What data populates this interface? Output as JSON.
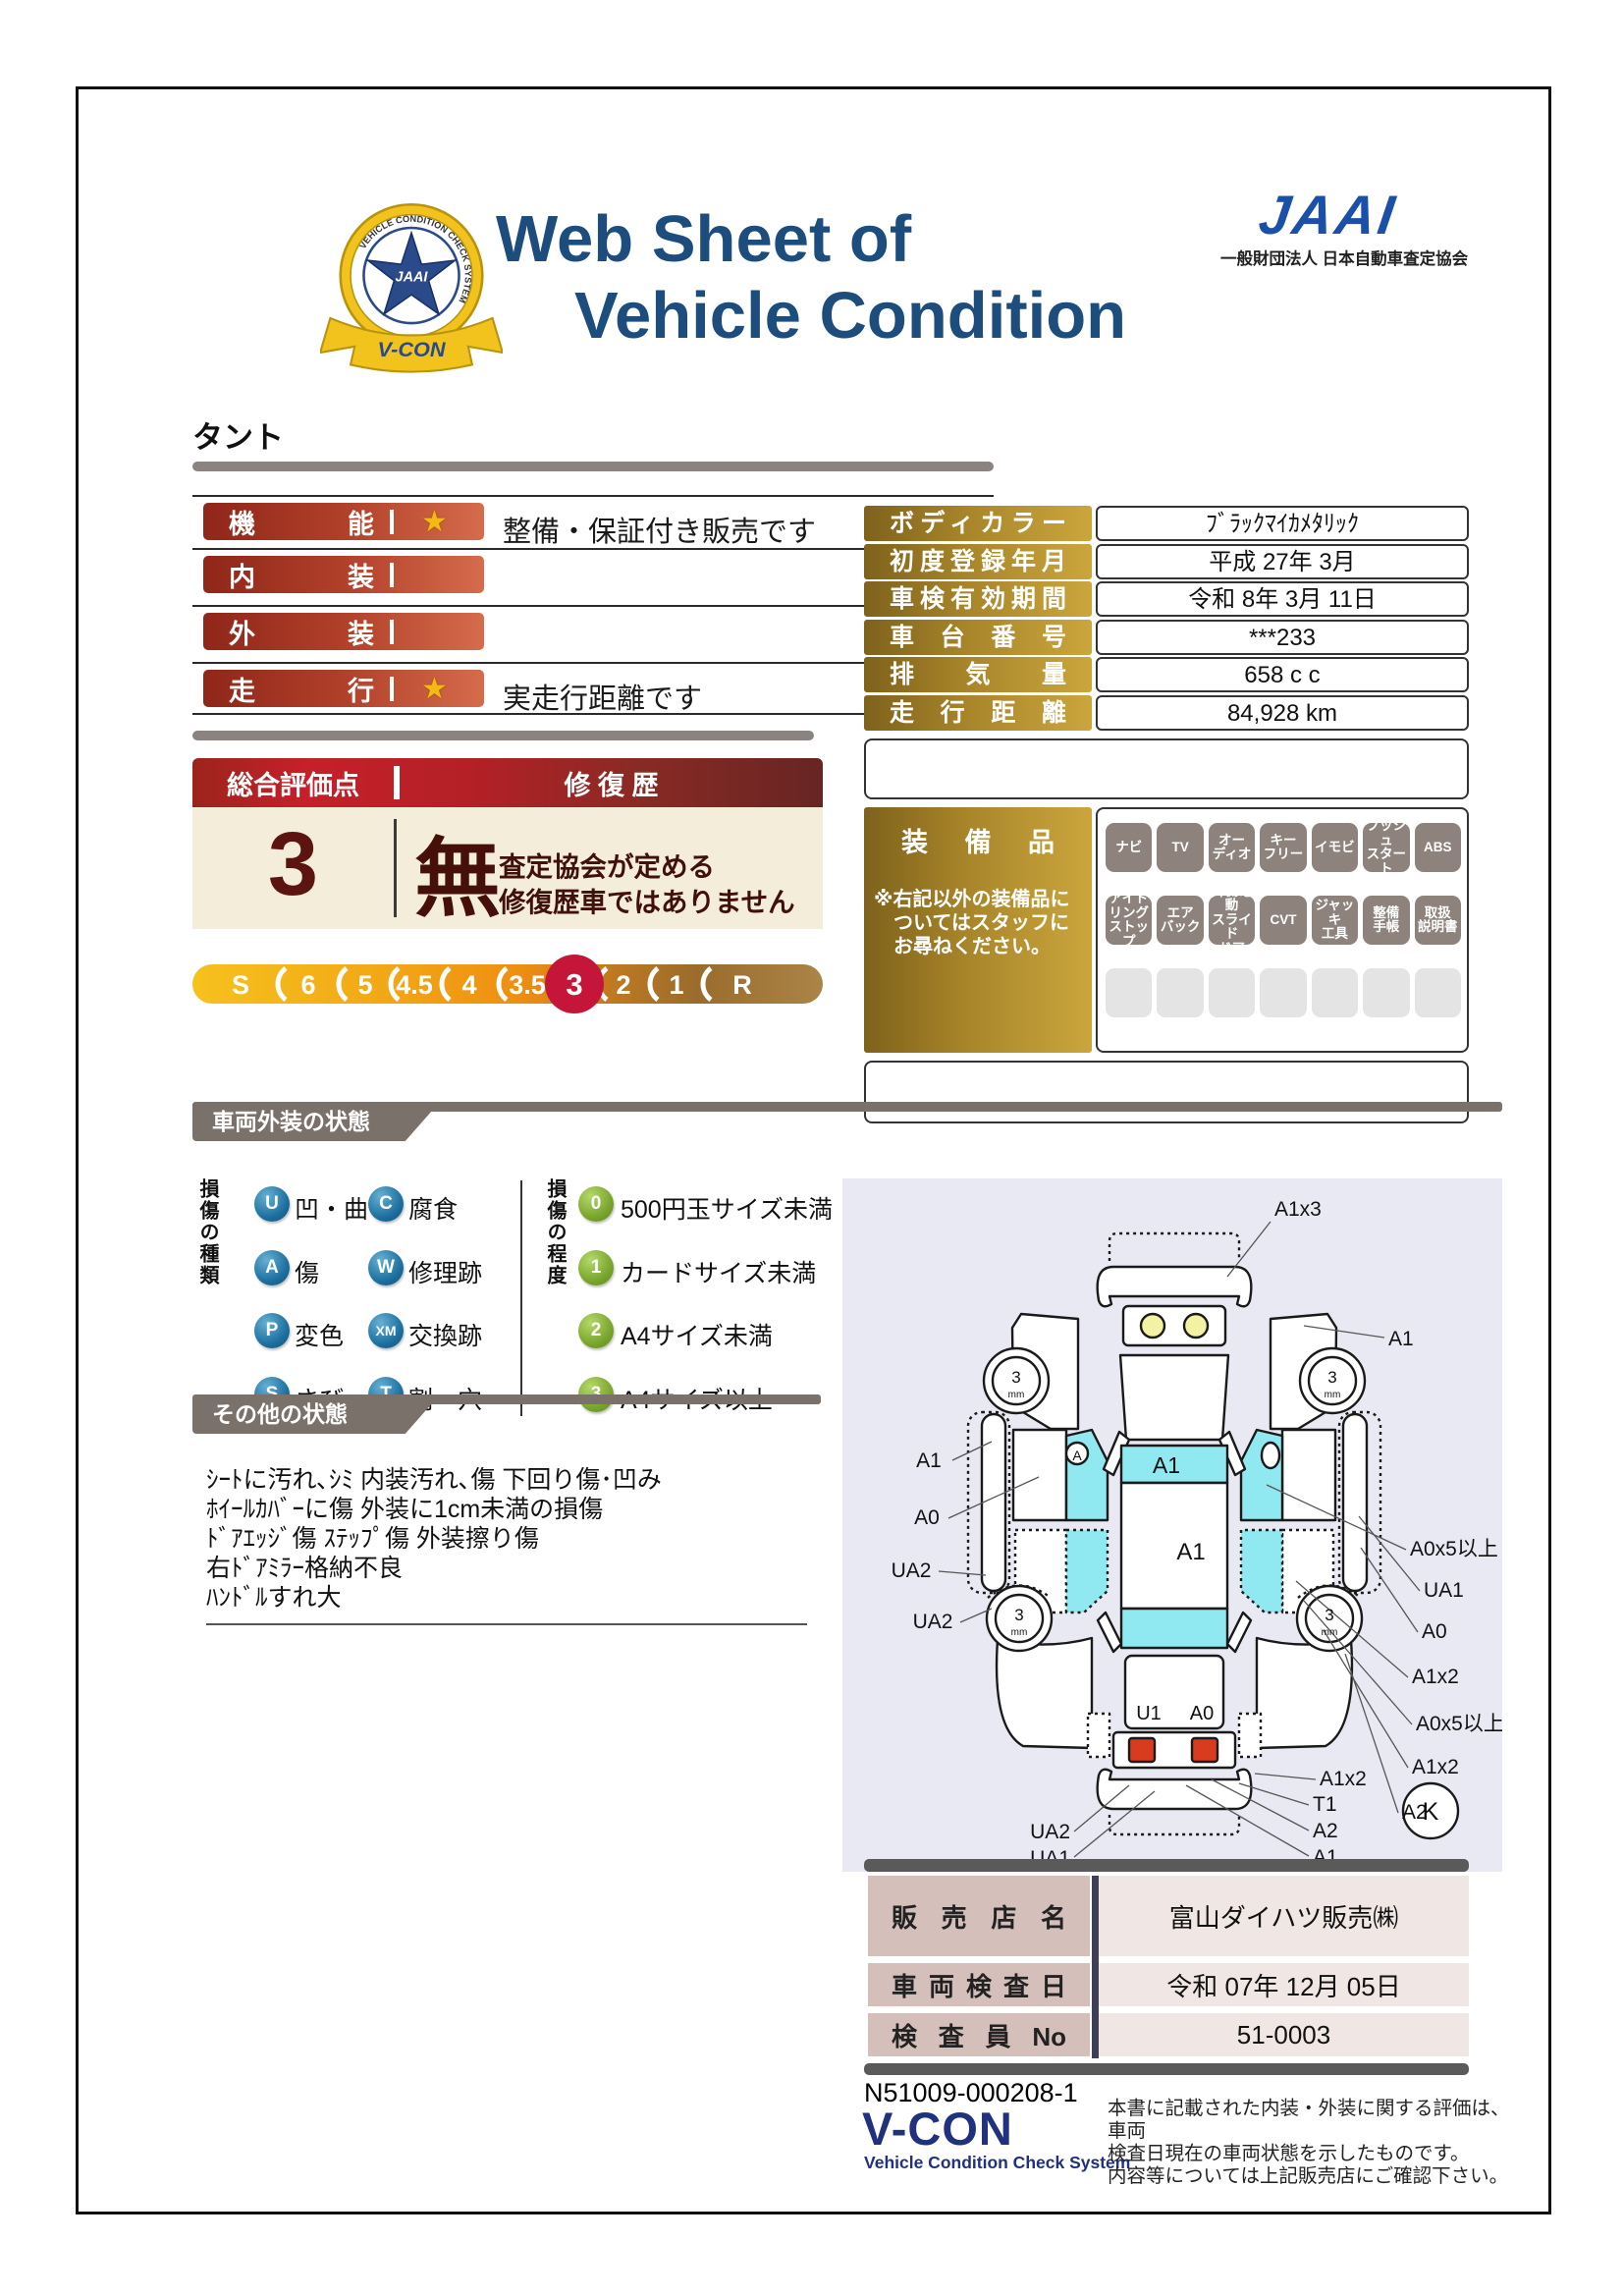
{
  "header": {
    "title_line1": "Web Sheet of",
    "title_line2": "Vehicle Condition",
    "jaai_mark": "JAAI",
    "jaai_org": "一般財団法人 日本自動車査定協会",
    "badge": {
      "ring": "VEHICLE CONDITION CHECK SYSTEM",
      "star_text": "JAAI",
      "ribbon": "V-CON"
    }
  },
  "vehicle": {
    "name": "タント"
  },
  "ratings": {
    "rows": [
      {
        "label": "機能",
        "star": true,
        "note": "整備・保証付き販売です"
      },
      {
        "label": "内装",
        "star": false,
        "note": ""
      },
      {
        "label": "外装",
        "star": false,
        "note": ""
      },
      {
        "label": "走行",
        "star": true,
        "note": "実走行距離です"
      }
    ]
  },
  "score": {
    "header_left": "総合評価点",
    "header_right": "修 復 歴",
    "value": "3",
    "repair": "無",
    "repair_note1": "査定協会が定める",
    "repair_note2": "修復歴車ではありません",
    "scale": [
      "S",
      "6",
      "5",
      "4.5",
      "4",
      "3.5",
      "3",
      "2",
      "1",
      "R"
    ],
    "selected": "3"
  },
  "info": {
    "rows": [
      {
        "label": "ボディカラー",
        "value": "ﾌﾞﾗｯｸﾏｲｶﾒﾀﾘｯｸ"
      },
      {
        "label": "初度登録年月",
        "value": "平成 27年 3月"
      },
      {
        "label": "車検有効期間",
        "value": "令和 8年 3月 11日"
      },
      {
        "label": "車台番号",
        "value": "***233"
      },
      {
        "label": "排気量",
        "value": "658 c c"
      },
      {
        "label": "走行距離",
        "value": "84,928 km"
      }
    ]
  },
  "equipment": {
    "title": "装備品",
    "note": "※右記以外の装備品に\n　ついてはスタッフに\n　お尋ねください。",
    "items": [
      "ナビ",
      "TV",
      "オー\nディオ",
      "キー\nフリー",
      "イモビ",
      "プッシュ\nスタート",
      "ABS",
      "アイド\nリング\nストップ",
      "エア\nバック",
      "片側電動\nスライド\nドア",
      "CVT",
      "ジャッキ\n工具",
      "整備\n手帳",
      "取扱\n説明書"
    ]
  },
  "exterior": {
    "title": "車両外装の状態",
    "kind_axis": "損傷の種類",
    "kinds": [
      {
        "code": "U",
        "label": "凹・曲"
      },
      {
        "code": "C",
        "label": "腐食"
      },
      {
        "code": "A",
        "label": "傷"
      },
      {
        "code": "W",
        "label": "修理跡"
      },
      {
        "code": "P",
        "label": "変色"
      },
      {
        "code": "XM",
        "label": "交換跡"
      },
      {
        "code": "S",
        "label": "さび"
      },
      {
        "code": "T",
        "label": "割・穴"
      }
    ],
    "degree_axis": "損傷の程度",
    "degrees": [
      {
        "code": "0",
        "label": "500円玉サイズ未満"
      },
      {
        "code": "1",
        "label": "カードサイズ未満"
      },
      {
        "code": "2",
        "label": "A4サイズ未満"
      },
      {
        "code": "3",
        "label": "A4サイズ以上"
      }
    ]
  },
  "other": {
    "title": "その他の状態",
    "text": "ｼｰﾄに汚れ､ｼﾐ 内装汚れ､傷 下回り傷･凹み\nﾎｲｰﾙｶﾊﾞｰに傷 外装に1cm未満の損傷\nﾄﾞｱｴｯｼﾞ傷 ｽﾃｯﾌﾟ傷 外装擦り傷\n右ﾄﾞｱﾐﾗｰ格納不良\nﾊﾝﾄﾞﾙすれ大"
  },
  "diagram": {
    "front_note": "A1x3",
    "tire_depth": "3",
    "tire_unit": "mm",
    "left_a1": "A1",
    "left_a0": "A0",
    "left_ua2_a": "UA2",
    "left_ua2_b": "UA2",
    "win_a": "A",
    "band_front": "A1",
    "roof": "A1",
    "gate_u1": "U1",
    "gate_a0": "A0",
    "r_a1": "A1",
    "r1": "A0x5以上",
    "r2": "UA1",
    "r3": "A0",
    "r4": "A1x2",
    "r5": "A0x5以上",
    "r6": "A1x2",
    "r7": "A2",
    "br1": "A1x2",
    "br2": "T1",
    "br3": "A2",
    "br4": "A1",
    "bl1": "UA2",
    "bl2": "UA1",
    "k": "K"
  },
  "sales": {
    "rows": [
      {
        "label": "販売店名",
        "value": "富山ダイハツ販売㈱"
      },
      {
        "label": "車両検査日",
        "value": "令和 07年 12月 05日"
      },
      {
        "label": "検査員No",
        "value": "51-0003"
      }
    ]
  },
  "footer": {
    "doc_no": "N51009-000208-1",
    "vcon": "V-CON",
    "vcon_sub": "Vehicle Condition Check System",
    "disclaimer": "本書に記載された内装・外装に関する評価は、車両\n検査日現在の車両状態を示したものです。\n内容等については上記販売店にご確認下さい。"
  },
  "colors": {
    "title_blue": "#1d4d7d",
    "jaai_blue": "#1b50a8",
    "accent_red": "#c6202a",
    "gold": "#a8852a",
    "cream": "#f4edda",
    "selected_score_red": "#c5163a",
    "cyan_damage": "#90e9f0",
    "diagram_bg": "#e9e9f4",
    "section_gray": "#7b716b"
  }
}
